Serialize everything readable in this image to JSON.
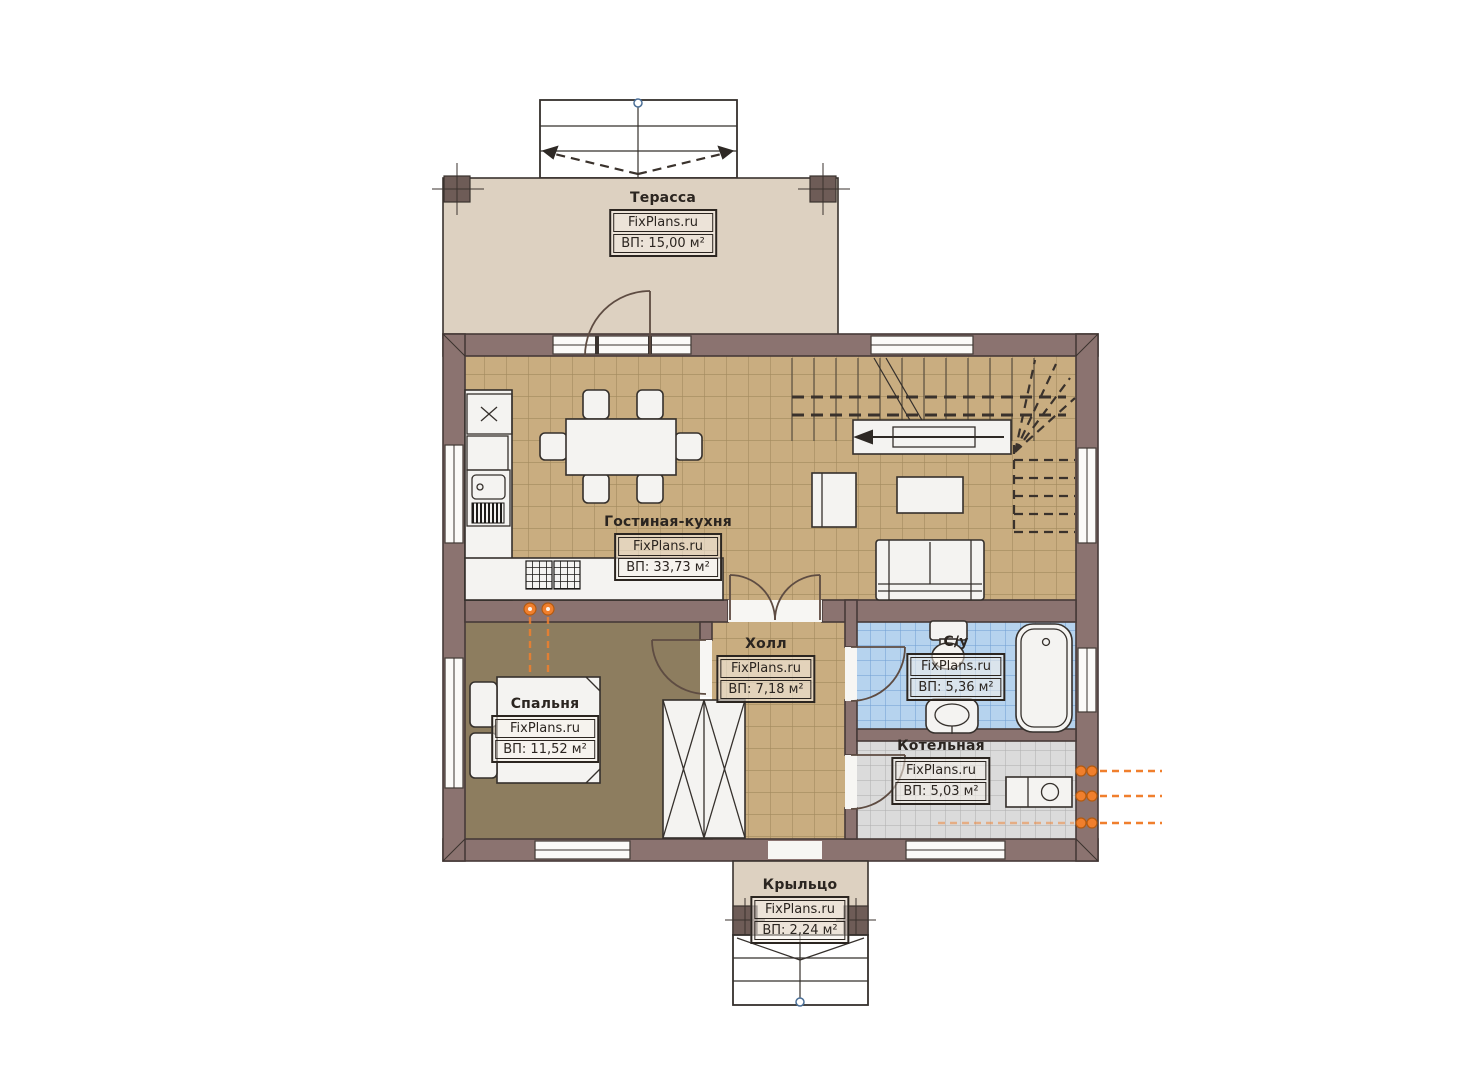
{
  "watermark": "FixPlans.ru",
  "rooms": [
    {
      "id": "terrace",
      "name": "Терасса",
      "area": "ВП: 15,00 м²"
    },
    {
      "id": "living-kitchen",
      "name": "Гостиная-кухня",
      "area": "ВП: 33,73 м²"
    },
    {
      "id": "hall",
      "name": "Холл",
      "area": "ВП: 7,18 м²"
    },
    {
      "id": "bathroom",
      "name": "С/у",
      "area": "ВП: 5,36 м²"
    },
    {
      "id": "bedroom",
      "name": "Спальня",
      "area": "ВП: 11,52 м²"
    },
    {
      "id": "boiler-room",
      "name": "Котельная",
      "area": "ВП: 5,03 м²"
    },
    {
      "id": "porch",
      "name": "Крыльцо",
      "area": "ВП: 2,24 м²"
    }
  ],
  "colors": {
    "wall": "#8b7370",
    "wallline": "#463a38",
    "tan": "#c9ad80",
    "tangrid": "#a28a5e",
    "beige": "#ddd1c1",
    "olive": "#8d7d5f",
    "blue": "#b6d3ee",
    "bluegrid": "#6e9ed2",
    "gray": "#dbdbdb",
    "graygrid": "#aeaeae",
    "furniture": "#f4f3f1",
    "orange": "#f07f2d",
    "ink": "#2b2520",
    "paper": "#ffffff"
  }
}
